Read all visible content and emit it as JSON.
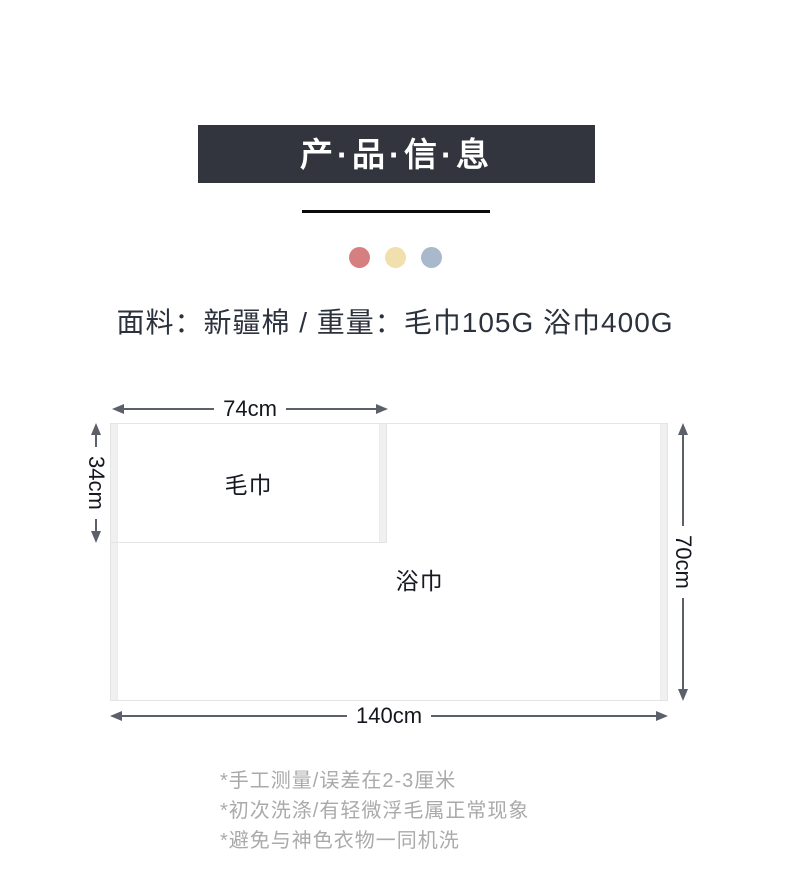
{
  "banner": {
    "title": "产·品·信·息",
    "bg_color": "#32343e",
    "text_color": "#ffffff"
  },
  "decor_dots": [
    {
      "name": "dot-red",
      "color": "#d67f80"
    },
    {
      "name": "dot-cream",
      "color": "#f1dfad"
    },
    {
      "name": "dot-blue",
      "color": "#a8b9cc"
    }
  ],
  "product_info": {
    "text": "面料：新疆棉 / 重量：毛巾105G 浴巾400G"
  },
  "diagram": {
    "towel": {
      "label": "毛巾",
      "width_label": "74cm",
      "height_label": "34cm"
    },
    "bath_towel": {
      "label": "浴巾",
      "width_label": "140cm",
      "height_label": "70cm"
    },
    "arrow_color": "#5b606b",
    "rect_border_color": "#e4e4e4",
    "hem_band_color": "#f0f0f0"
  },
  "notes": {
    "lines": [
      "*手工测量/误差在2-3厘米",
      "*初次洗涤/有轻微浮毛属正常现象",
      "*避免与神色衣物一同机洗"
    ],
    "color": "#aaaaaa"
  }
}
